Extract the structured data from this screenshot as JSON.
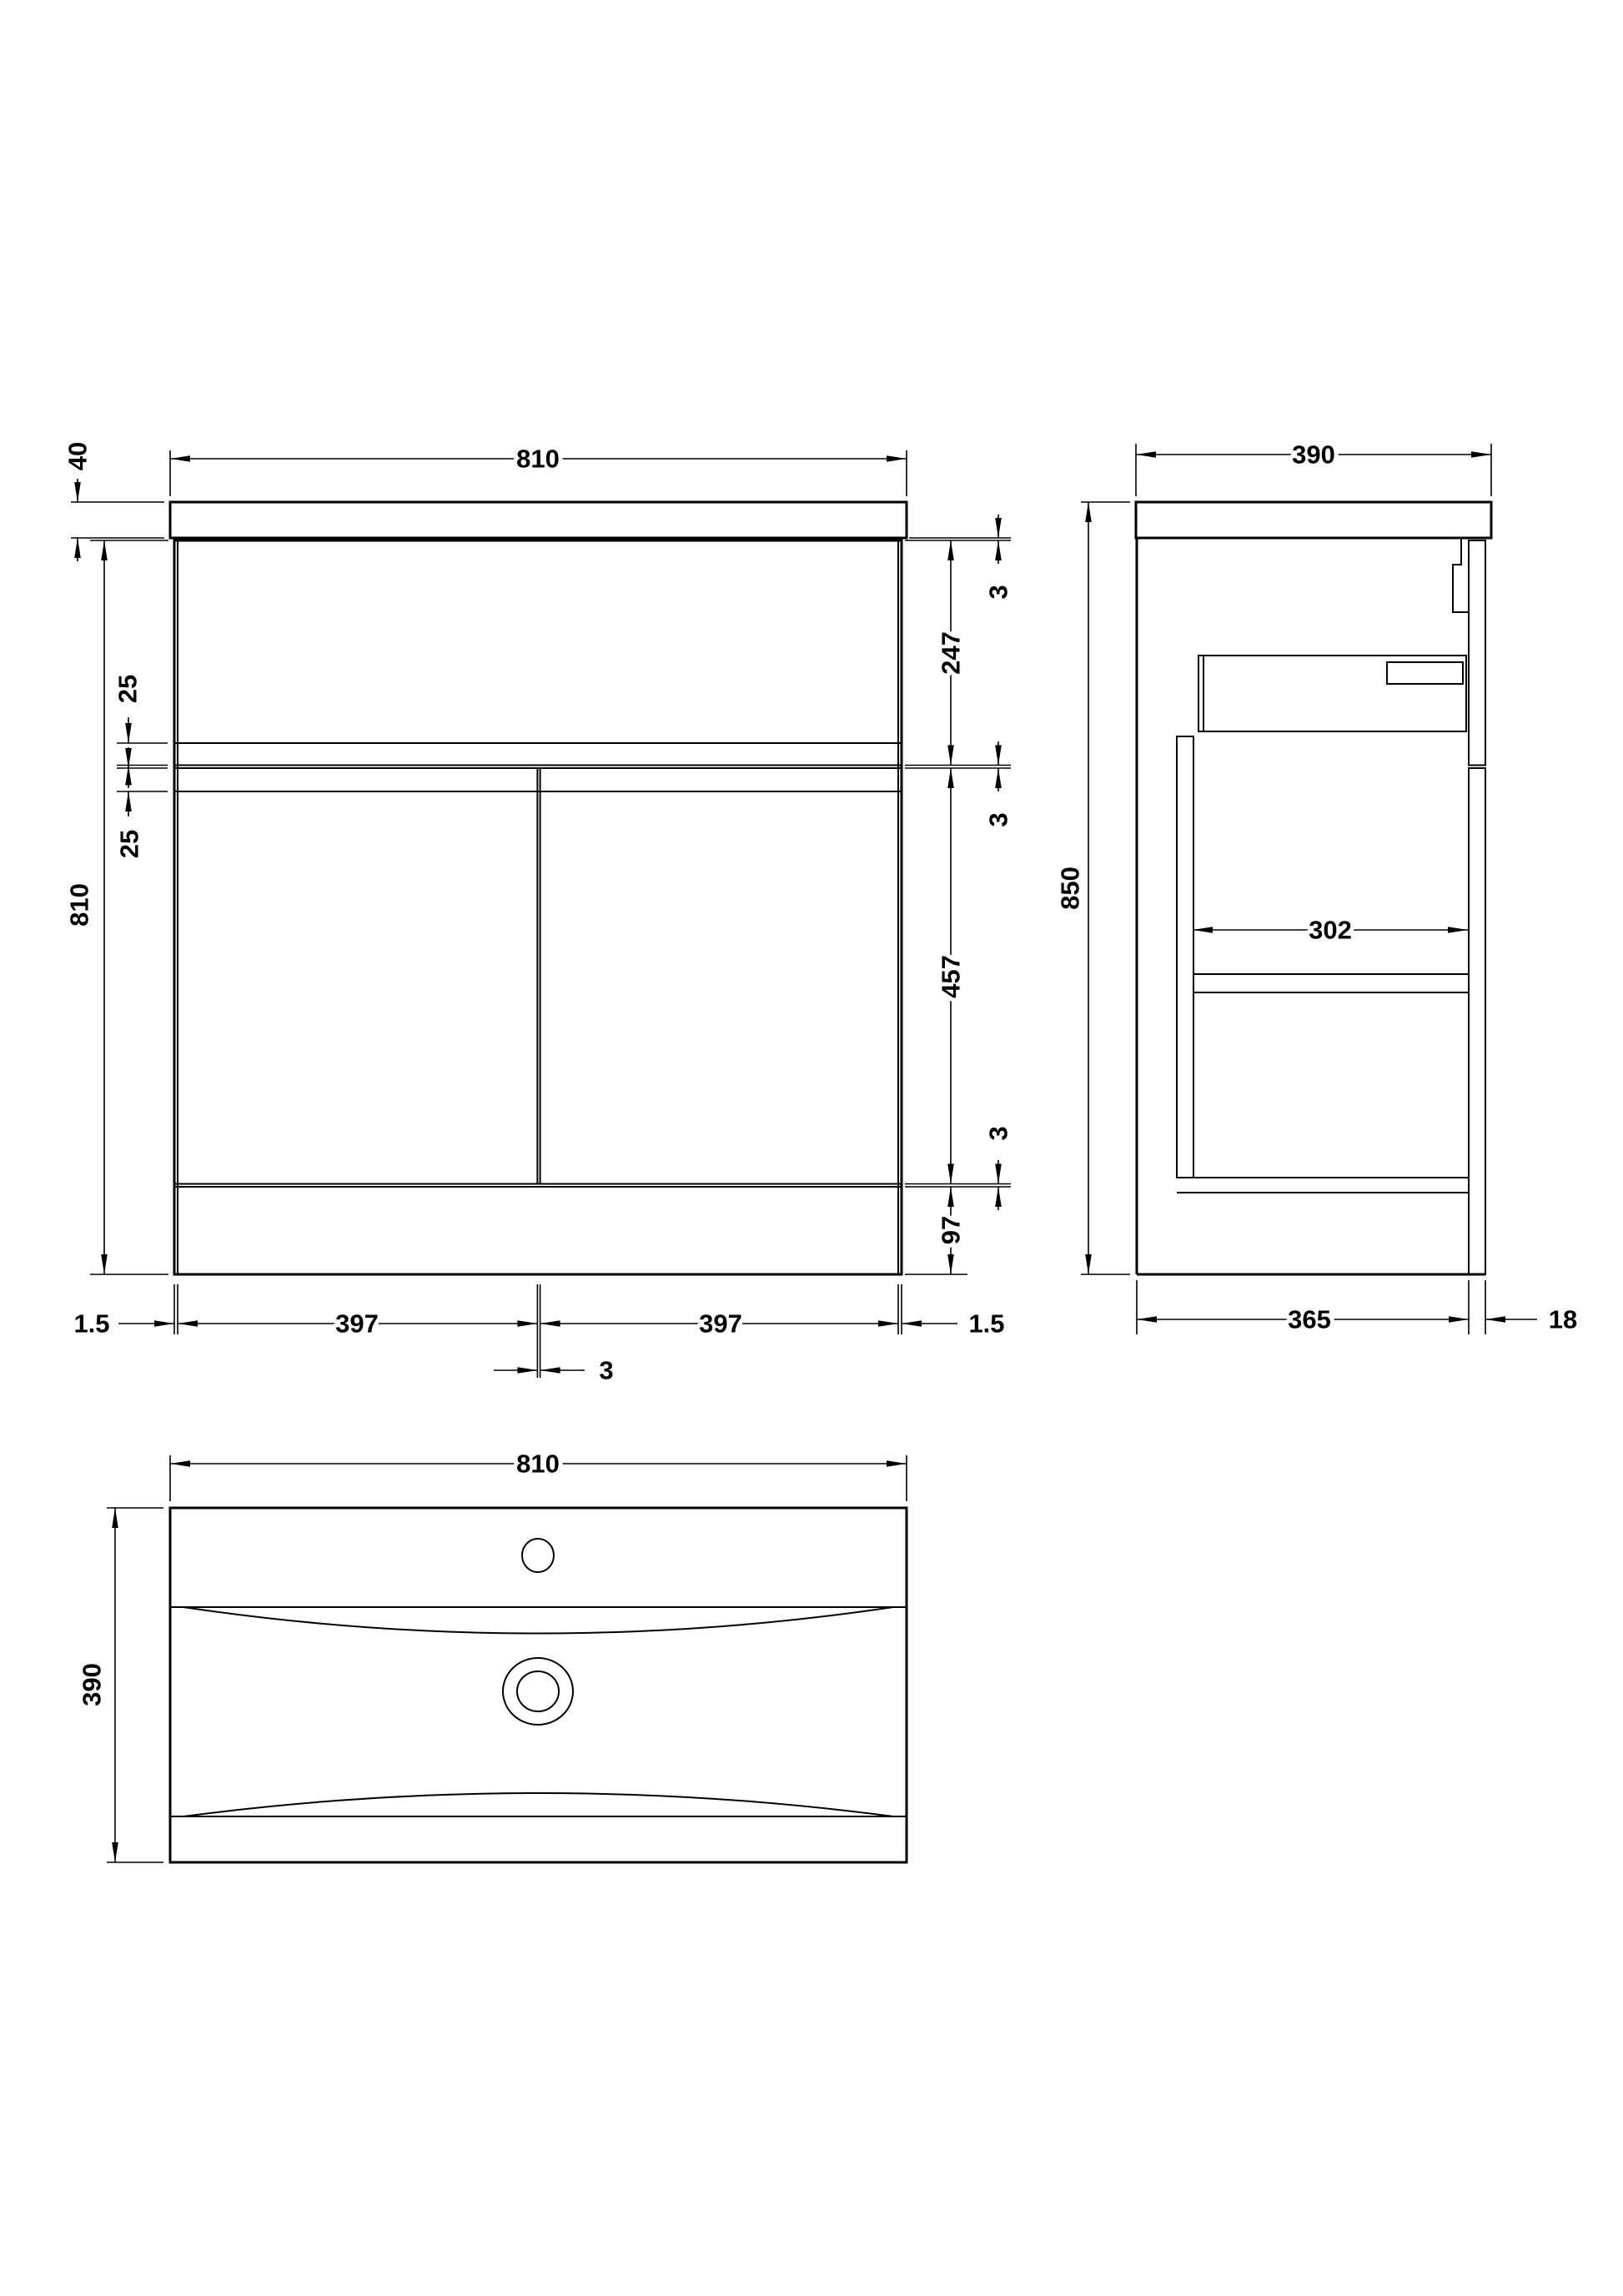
{
  "drawing": {
    "type": "technical-dimension-drawing",
    "subject": "floor-standing vanity unit with basin",
    "line_color": "#000000",
    "background_color": "#ffffff"
  },
  "front_view": {
    "name": "front-elevation",
    "dims": {
      "basin_width": "810",
      "worktop_thickness": "40",
      "cabinet_height": "810",
      "top_gap": "3",
      "drawer_front_height": "247",
      "mid_gap": "3",
      "door_height": "457",
      "bottom_gap": "3",
      "plinth_height": "97",
      "upper_rail_inset": "25",
      "lower_rail_inset": "25",
      "left_edge_gap": "1.5",
      "left_door_width": "397",
      "right_door_width": "397",
      "right_edge_gap": "1.5",
      "door_gap": "3"
    }
  },
  "side_view": {
    "name": "side-section",
    "dims": {
      "worktop_depth": "390",
      "overall_height": "850",
      "internal_depth": "302",
      "carcass_depth": "365",
      "door_thickness": "18"
    }
  },
  "plan_view": {
    "name": "basin-plan",
    "dims": {
      "basin_width": "810",
      "basin_depth": "390"
    }
  }
}
